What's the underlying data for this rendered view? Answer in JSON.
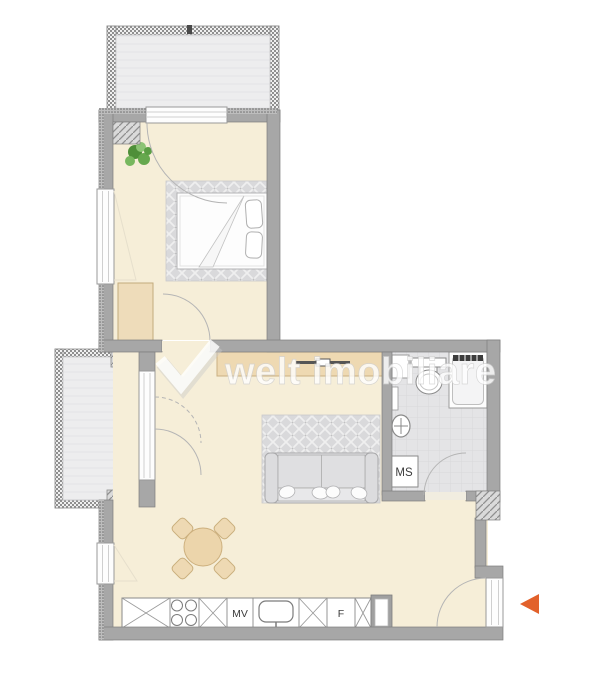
{
  "watermark": {
    "logo": "check-icon",
    "text": "welt imobiliare"
  },
  "labels": {
    "dishwasher": "MV",
    "fridge": "F",
    "washing_machine": "MS"
  },
  "colors": {
    "accent_orange": "#e2612b",
    "floor_cream": "#f6eed8",
    "furniture_beige": "#eed9b2",
    "wall_gray": "#a7a7a7",
    "balcony_floor_gray": "#ededee",
    "rug_gray": "#d9d9db",
    "bathroom_tile_gray": "#e4e4e6",
    "plant_green": "#5a9e44",
    "watermark_white": "#ffffff"
  },
  "furniture_icons": [
    "bed-icon",
    "wardrobe-icon",
    "plant-icon",
    "sideboard-icon",
    "tv-icon",
    "sofa-icon",
    "dining-table-icon",
    "chair-icon",
    "kitchen-counter-icon",
    "hob-icon",
    "kitchen-sink-icon",
    "toilet-icon",
    "shower-icon",
    "washbasin-icon",
    "washing-machine-icon",
    "entrance-arrow-icon"
  ]
}
